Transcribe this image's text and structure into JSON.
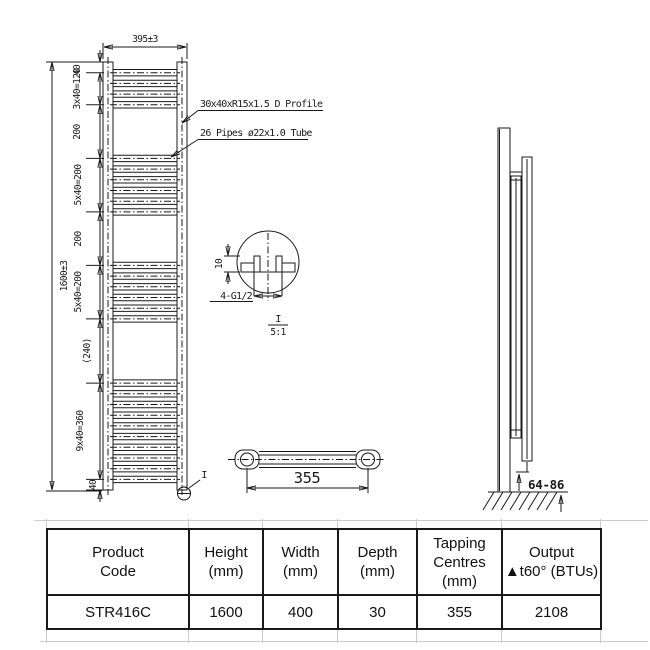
{
  "colors": {
    "line": "#1a1a1a",
    "wall_dark": "#3a3a3a",
    "metal_light": "#cdcdcd"
  },
  "drawing": {
    "front": {
      "width_dim": "395±3",
      "height_dim": "1600±3",
      "segments": [
        "40",
        "3x40=120",
        "200",
        "5x40=200",
        "200",
        "5x40=200",
        "(240)",
        "9x40=360",
        "40"
      ],
      "tube_groups": [
        4,
        6,
        6,
        10
      ],
      "callout_profile": "30x40xR15x1.5 D Profile",
      "callout_pipes": "26 Pipes ø22x1.0 Tube",
      "detail_ref": "I"
    },
    "detail": {
      "height_dim": "10",
      "thread_label": "4-G1/2",
      "id": "I",
      "scale": "5:1"
    },
    "bracket": {
      "centres_dim": "355"
    },
    "side": {
      "floor_gap_dim": "64-86"
    }
  },
  "table": {
    "columns": [
      {
        "h1": "Product",
        "h2": "Code",
        "h3": "",
        "value": "STR416C"
      },
      {
        "h1": "Height",
        "h2": "(mm)",
        "h3": "",
        "value": "1600"
      },
      {
        "h1": "Width",
        "h2": "(mm)",
        "h3": "",
        "value": "400"
      },
      {
        "h1": "Depth",
        "h2": "(mm)",
        "h3": "",
        "value": "30"
      },
      {
        "h1": "Tapping",
        "h2": "Centres",
        "h3": "(mm)",
        "value": "355"
      },
      {
        "h1": "Output",
        "h2": "▲t60° (BTUs)",
        "h3": "",
        "value": "2108"
      }
    ]
  }
}
